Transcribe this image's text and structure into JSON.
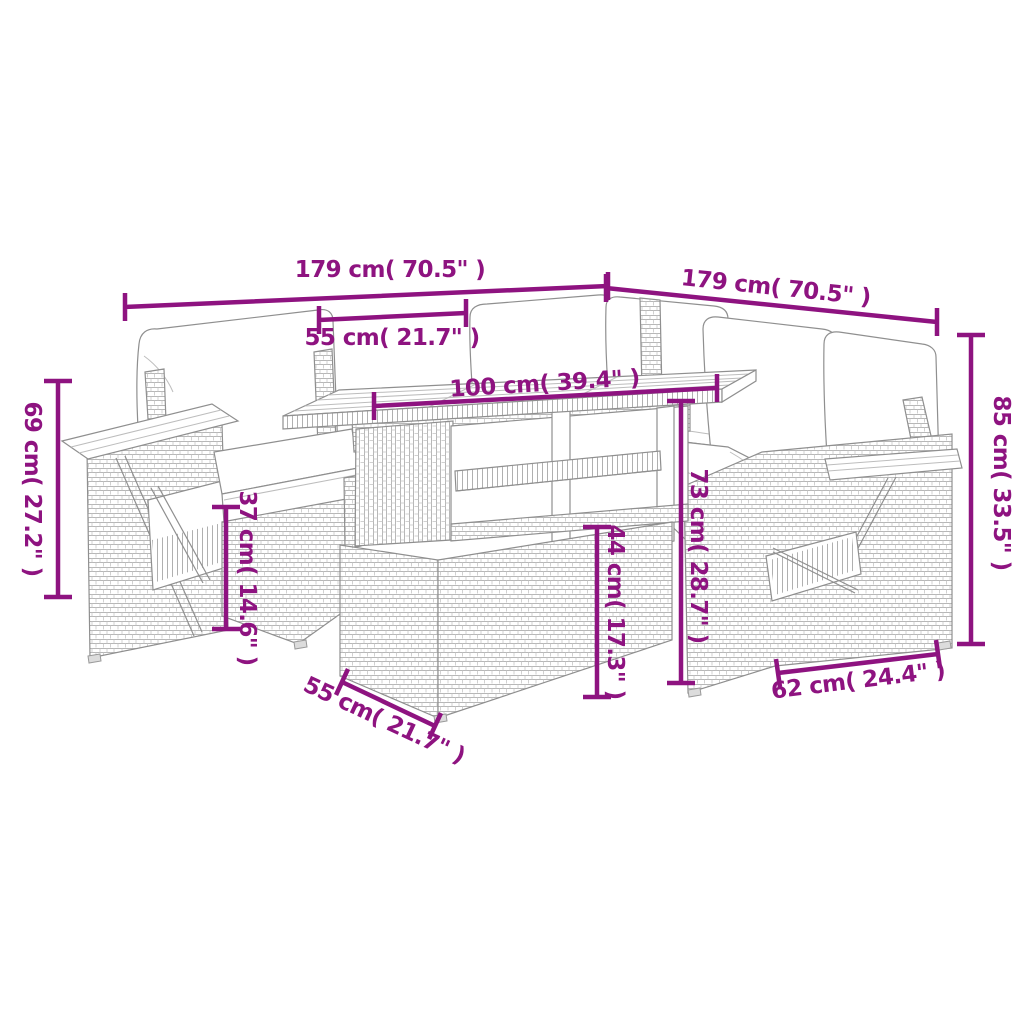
{
  "diagram": {
    "accent_color": "#8E1380",
    "art_color": "#8f8f8f",
    "dims": {
      "d179_left": "179 cm( 70.5\" )",
      "d179_right": "179 cm( 70.5\" )",
      "d55_top": "55 cm( 21.7\" )",
      "d100": "100 cm( 39.4\" )",
      "d73": "73 cm( 28.7\" )",
      "d44": "44 cm( 17.3\" )",
      "d37": "37 cm( 14.6\" )",
      "d69": "69 cm( 27.2\" )",
      "d85": "85 cm( 33.5\" )",
      "d55_bottom": "55 cm( 21.7\" )",
      "d62": "62 cm( 24.4\" )"
    }
  }
}
